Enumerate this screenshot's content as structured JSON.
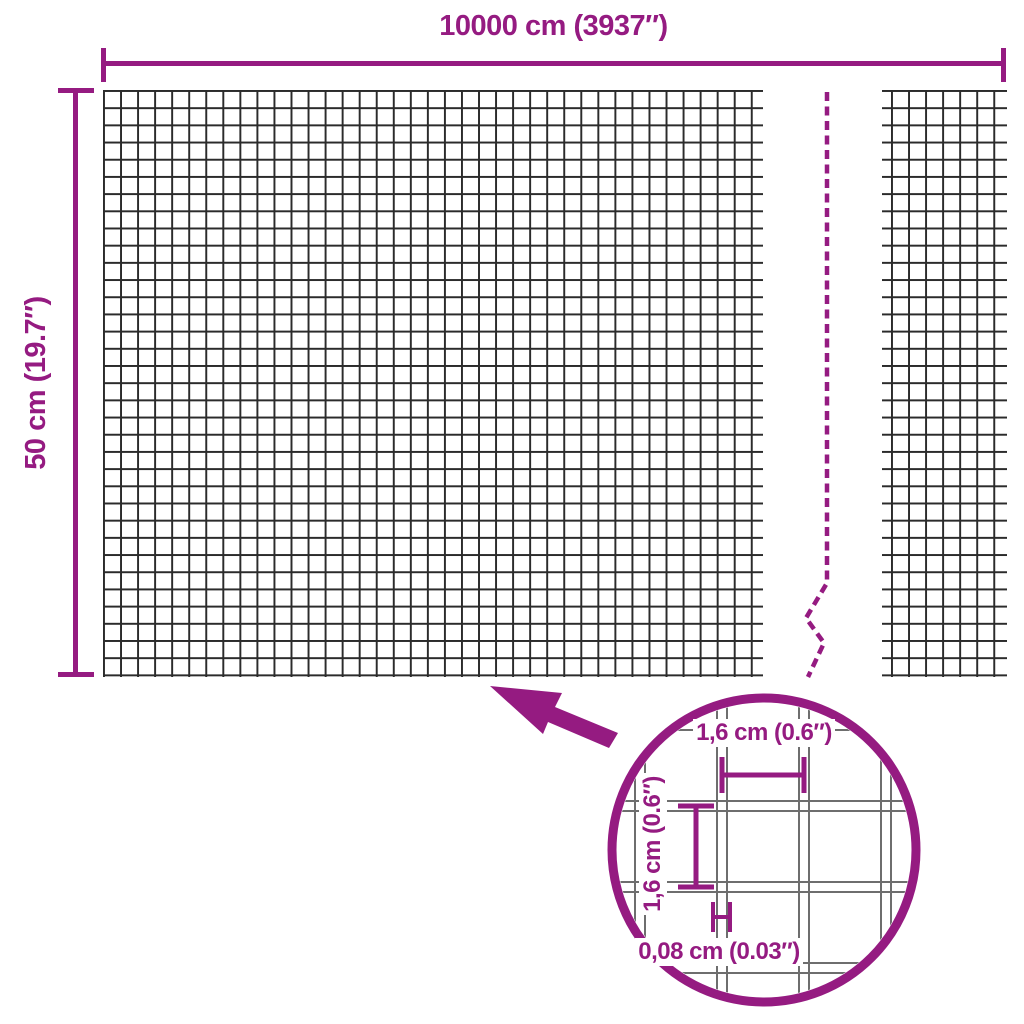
{
  "diagram_type": "product-dimension-diagram",
  "product": "welded wire mesh roll",
  "colors": {
    "accent": "#951b81",
    "mesh_line": "#2b2b2b",
    "detail_wire": "#6e6e6e",
    "bg": "#ffffff"
  },
  "dimensions": {
    "overall_width": {
      "label": "10000 cm (3937″)"
    },
    "overall_height": {
      "label": "50 cm (19.7″)"
    },
    "detail_mesh_width": {
      "label": "1,6 cm (0.6″)"
    },
    "detail_mesh_height": {
      "label": "1,6 cm (0.6″)"
    },
    "detail_wire_thickness": {
      "label": "0,08 cm (0.03″)"
    }
  }
}
